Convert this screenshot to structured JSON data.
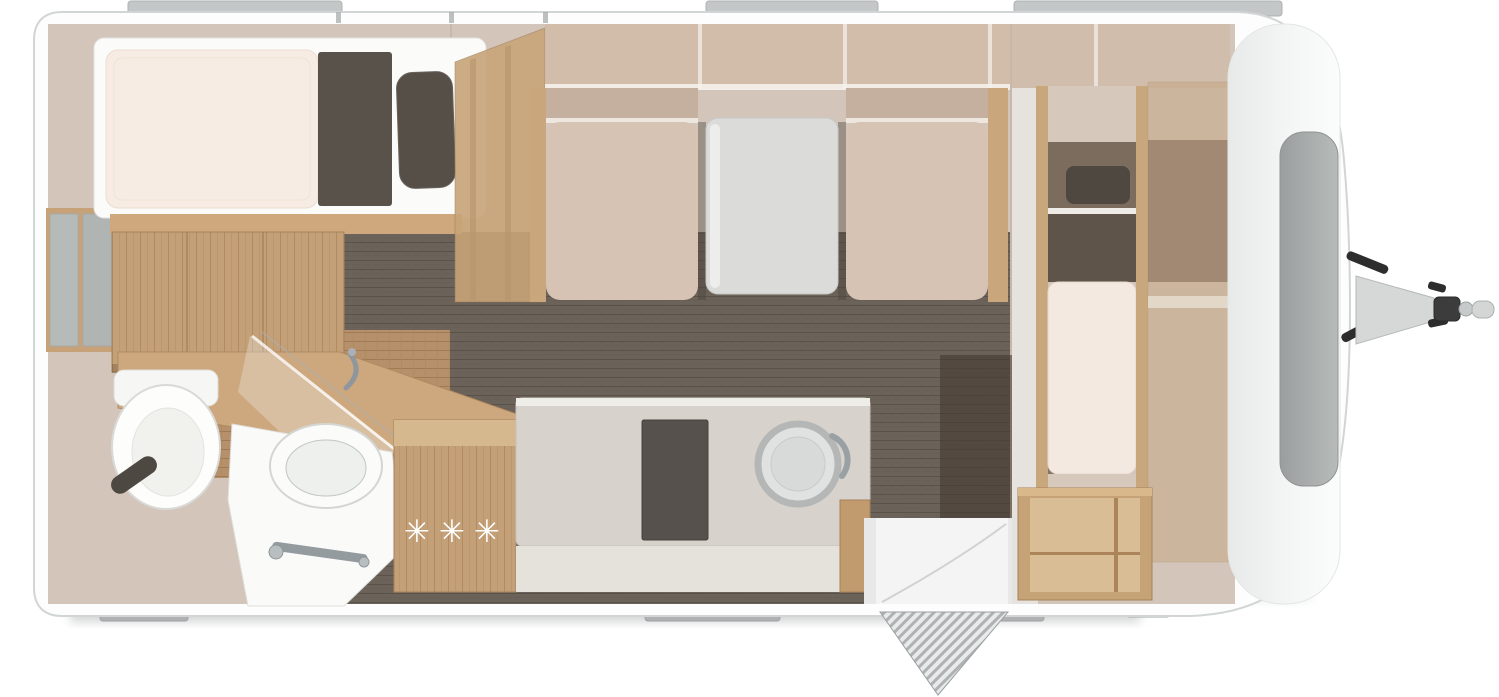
{
  "floorplan": {
    "view": "top-down caravan floor plan",
    "kitchen": {
      "burners_label": "✳✳✳"
    },
    "palette": {
      "body_white": "#fdfdfd",
      "body_outline": "#d2d5d5",
      "wall_window_gray": "#b9bdbd",
      "interior_beige": "#d3c5b9",
      "overhead_locker_beige": "#d1baa7",
      "floor_dark": "#6b6259",
      "floor_bath_wood": "#b5906a",
      "wood": "#c7a379",
      "wood_light": "#d6b88e",
      "mattress_cream": "#f7ece3",
      "bedding_dark": "#59524b",
      "pillow_dark": "#564f48",
      "seat_beige": "#d7c3b4",
      "seat_back_beige": "#c5af9e",
      "table_gray": "#dbdbd9",
      "counter_gray": "#d7d3cc",
      "appliance_dark": "#56514c",
      "fixture_white": "#fafaf9",
      "chrome": "#949b9f",
      "front_window_gray": "#a2a6a6",
      "hitch_gray": "#d6d8d8",
      "hitch_black": "#2d2d2d"
    }
  }
}
